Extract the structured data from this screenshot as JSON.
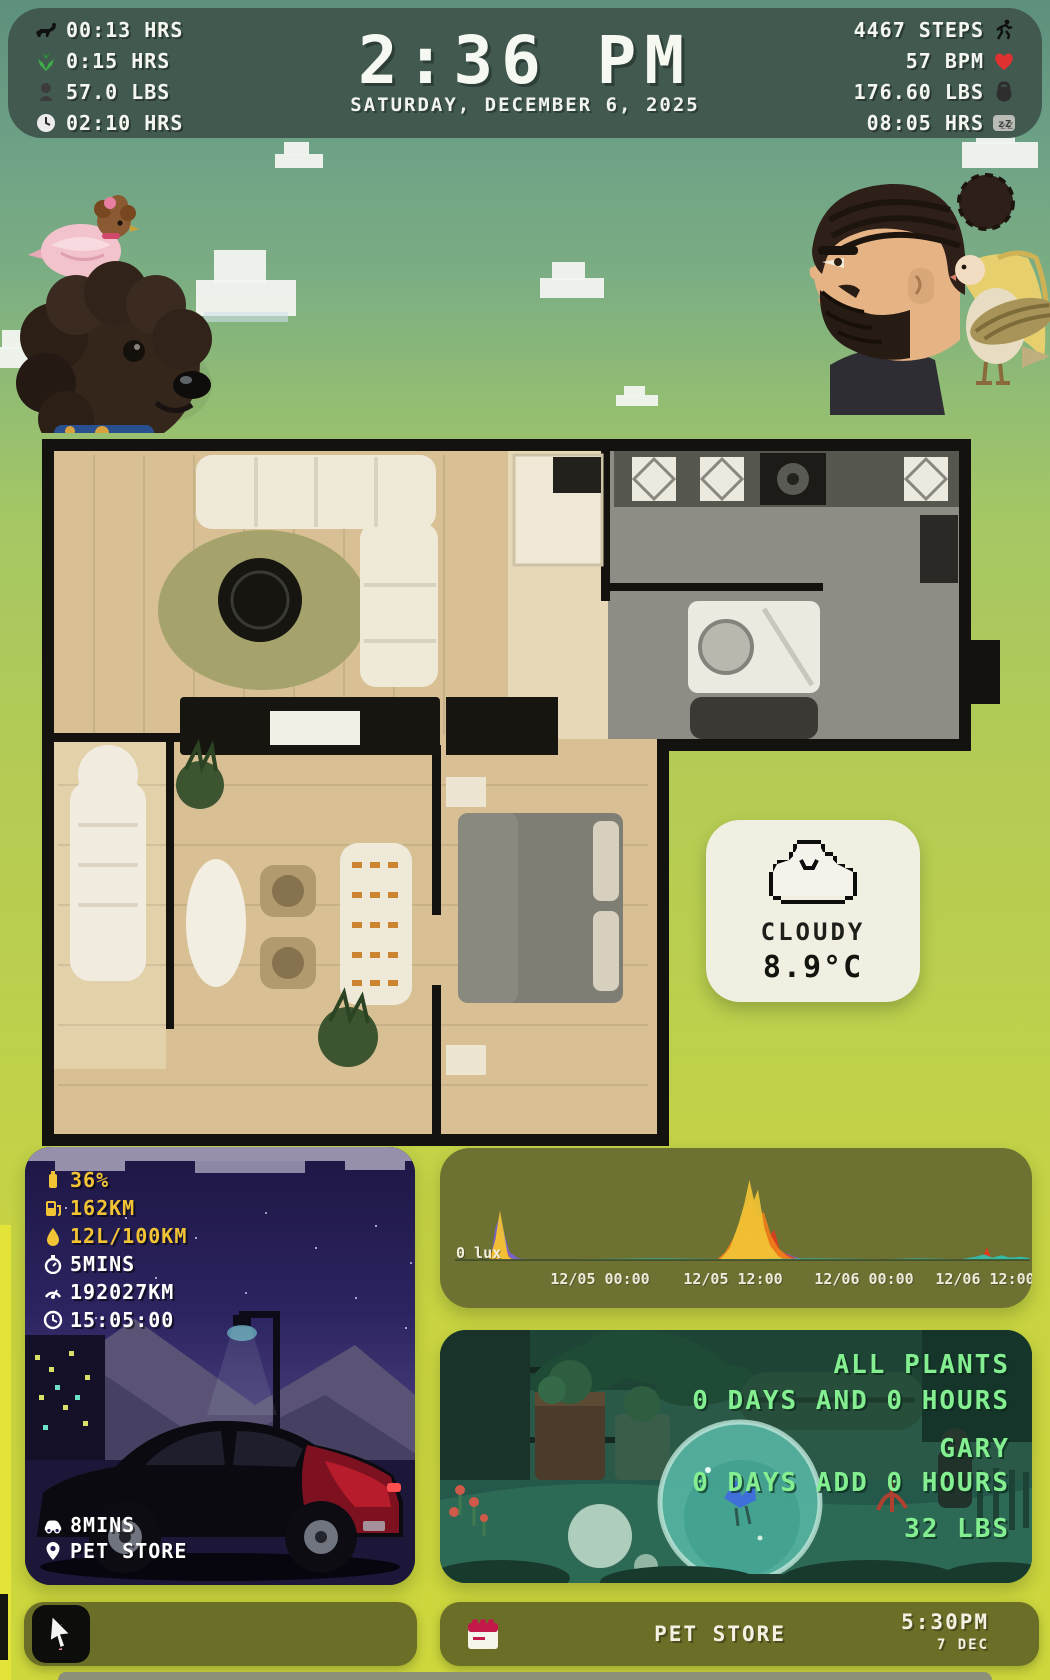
{
  "header": {
    "time": "2:36 PM",
    "date": "SATURDAY, DECEMBER 6, 2025",
    "left_stats": [
      {
        "icon": "dog-walk-icon",
        "value": "00:13 HRS"
      },
      {
        "icon": "plant-icon",
        "value": "0:15 HRS"
      },
      {
        "icon": "pet-weight-icon",
        "value": "57.0 LBS"
      },
      {
        "icon": "clock-icon",
        "value": "02:10 HRS"
      }
    ],
    "right_stats": [
      {
        "icon": "runner-icon",
        "value": "4467 STEPS"
      },
      {
        "icon": "heart-icon",
        "value": "57 BPM"
      },
      {
        "icon": "kettlebell-icon",
        "value": "176.60 LBS"
      },
      {
        "icon": "sleep-icon",
        "value": "08:05 HRS"
      }
    ]
  },
  "weather": {
    "icon": "cloud-icon",
    "condition": "CLOUDY",
    "temperature": "8.9°C"
  },
  "car": {
    "stats": [
      {
        "icon": "battery-icon",
        "value": "36%",
        "color": "#f2c335"
      },
      {
        "icon": "fuel-pump-icon",
        "value": "162KM",
        "color": "#f2c335"
      },
      {
        "icon": "fuel-drop-icon",
        "value": "12L/100KM",
        "color": "#f2c335"
      },
      {
        "icon": "timer-icon",
        "value": "5MINS",
        "color": "#ffffff"
      },
      {
        "icon": "odometer-icon",
        "value": "192027KM",
        "color": "#ffffff"
      },
      {
        "icon": "clock-icon",
        "value": "15:05:00",
        "color": "#ffffff"
      }
    ],
    "footer": [
      {
        "icon": "car-icon",
        "value": "8MINS"
      },
      {
        "icon": "map-pin-icon",
        "value": "PET STORE"
      }
    ]
  },
  "chart_data": {
    "type": "area",
    "title": "Ambient light sensor",
    "ylabel": "lux",
    "baseline_label": "0 lux",
    "x_ticks": [
      "12/05 00:00",
      "12/05 12:00",
      "12/06 00:00",
      "12/06 12:00"
    ],
    "x_tick_fractions": [
      0.252,
      0.483,
      0.711,
      0.936
    ],
    "ylim_relative": [
      0,
      100
    ],
    "grid": false,
    "legend": "none",
    "series": [
      {
        "name": "purple",
        "color": "#7a5fd0",
        "points": [
          [
            0,
            0
          ],
          [
            0.062,
            0
          ],
          [
            0.07,
            40
          ],
          [
            0.078,
            55
          ],
          [
            0.087,
            30
          ],
          [
            0.095,
            10
          ],
          [
            0.11,
            2
          ],
          [
            0.13,
            0
          ],
          [
            0.45,
            0
          ],
          [
            0.48,
            6
          ],
          [
            0.51,
            12
          ],
          [
            0.54,
            9
          ],
          [
            0.57,
            10
          ],
          [
            0.59,
            4
          ],
          [
            0.61,
            0
          ],
          [
            1,
            0
          ]
        ]
      },
      {
        "name": "slate",
        "color": "#8a8fa8",
        "points": [
          [
            0,
            0
          ],
          [
            0.46,
            0
          ],
          [
            0.49,
            8
          ],
          [
            0.52,
            14
          ],
          [
            0.545,
            7
          ],
          [
            0.57,
            9
          ],
          [
            0.59,
            3
          ],
          [
            0.62,
            0
          ],
          [
            1,
            0
          ]
        ]
      },
      {
        "name": "red",
        "color": "#e03a1d",
        "points": [
          [
            0,
            0
          ],
          [
            0.45,
            0
          ],
          [
            0.47,
            4
          ],
          [
            0.49,
            15
          ],
          [
            0.51,
            30
          ],
          [
            0.525,
            25
          ],
          [
            0.535,
            35
          ],
          [
            0.545,
            28
          ],
          [
            0.555,
            38
          ],
          [
            0.565,
            12
          ],
          [
            0.58,
            6
          ],
          [
            0.6,
            0
          ],
          [
            0.915,
            0
          ],
          [
            0.925,
            16
          ],
          [
            0.933,
            2
          ],
          [
            0.945,
            0
          ],
          [
            1,
            0
          ]
        ]
      },
      {
        "name": "orange",
        "color": "#ef7f1a",
        "points": [
          [
            0,
            0
          ],
          [
            0.058,
            0
          ],
          [
            0.068,
            18
          ],
          [
            0.076,
            45
          ],
          [
            0.084,
            22
          ],
          [
            0.095,
            3
          ],
          [
            0.105,
            0
          ],
          [
            0.455,
            0
          ],
          [
            0.47,
            10
          ],
          [
            0.49,
            35
          ],
          [
            0.503,
            60
          ],
          [
            0.515,
            80
          ],
          [
            0.527,
            55
          ],
          [
            0.537,
            60
          ],
          [
            0.55,
            30
          ],
          [
            0.562,
            15
          ],
          [
            0.578,
            5
          ],
          [
            0.59,
            0
          ],
          [
            1,
            0
          ]
        ]
      },
      {
        "name": "yellow",
        "color": "#f2c335",
        "points": [
          [
            0,
            0
          ],
          [
            0.06,
            0
          ],
          [
            0.07,
            25
          ],
          [
            0.078,
            62
          ],
          [
            0.085,
            35
          ],
          [
            0.092,
            5
          ],
          [
            0.1,
            0
          ],
          [
            0.46,
            0
          ],
          [
            0.478,
            15
          ],
          [
            0.493,
            45
          ],
          [
            0.503,
            70
          ],
          [
            0.512,
            100
          ],
          [
            0.52,
            75
          ],
          [
            0.527,
            88
          ],
          [
            0.538,
            40
          ],
          [
            0.548,
            18
          ],
          [
            0.562,
            5
          ],
          [
            0.575,
            0
          ],
          [
            1,
            0
          ]
        ]
      },
      {
        "name": "teal",
        "color": "#2fbfae",
        "points": [
          [
            0,
            1
          ],
          [
            0.2,
            1
          ],
          [
            0.35,
            2
          ],
          [
            0.5,
            1
          ],
          [
            0.62,
            2
          ],
          [
            0.75,
            1
          ],
          [
            0.8,
            2
          ],
          [
            0.88,
            1
          ],
          [
            0.905,
            4
          ],
          [
            0.92,
            7
          ],
          [
            0.935,
            3
          ],
          [
            0.95,
            6
          ],
          [
            0.965,
            3
          ],
          [
            0.985,
            4
          ],
          [
            1,
            2
          ]
        ]
      }
    ]
  },
  "plants": {
    "all_label": "ALL PLANTS",
    "all_value": "0 DAYS AND 0 HOURS",
    "pet_name": "GARY",
    "pet_value": "0 DAYS ADD 0 HOURS",
    "weight": "32 LBS"
  },
  "footer_bar": {
    "media_icon": "cursor-play-icon",
    "event": {
      "icon": "calendar-icon",
      "title": "PET STORE",
      "time": "5:30PM",
      "date": "7 DEC"
    }
  },
  "colors": {
    "header_bg": "#41594f",
    "accent_yellow": "#f2c335",
    "plant_green": "#84ef90",
    "olive_tile": "#6b6e27",
    "heart_red": "#e03131"
  }
}
